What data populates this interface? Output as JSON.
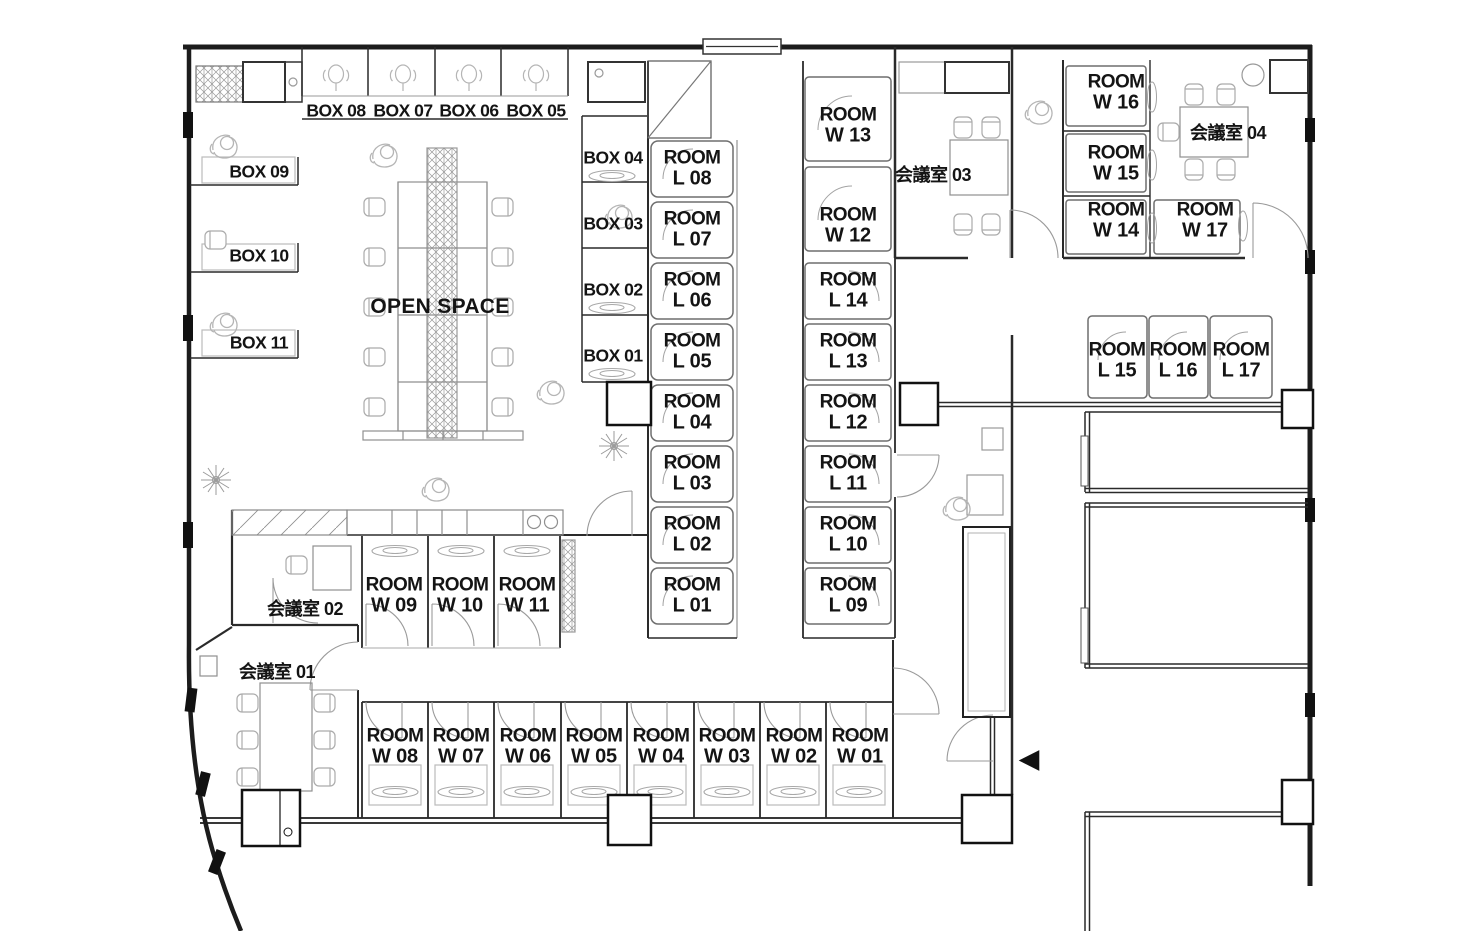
{
  "plan": {
    "open_space": "OPEN SPACE",
    "room_word": "ROOM",
    "entrance_arrow": "◀",
    "boxes": {
      "b01": "BOX 01",
      "b02": "BOX 02",
      "b03": "BOX 03",
      "b04": "BOX 04",
      "b05": "BOX 05",
      "b06": "BOX 06",
      "b07": "BOX 07",
      "b08": "BOX 08",
      "b09": "BOX 09",
      "b10": "BOX 10",
      "b11": "BOX 11"
    },
    "l_rooms": {
      "l01": "L 01",
      "l02": "L 02",
      "l03": "L 03",
      "l04": "L 04",
      "l05": "L 05",
      "l06": "L 06",
      "l07": "L 07",
      "l08": "L 08",
      "l09": "L 09",
      "l10": "L 10",
      "l11": "L 11",
      "l12": "L 12",
      "l13": "L 13",
      "l14": "L 14",
      "l15": "L 15",
      "l16": "L 16",
      "l17": "L 17"
    },
    "w_rooms": {
      "w01": "W 01",
      "w02": "W 02",
      "w03": "W 03",
      "w04": "W 04",
      "w05": "W 05",
      "w06": "W 06",
      "w07": "W 07",
      "w08": "W 08",
      "w09": "W 09",
      "w10": "W 10",
      "w11": "W 11",
      "w12": "W 12",
      "w13": "W 13",
      "w14": "W 14",
      "w15": "W 15",
      "w16": "W 16",
      "w17": "W 17"
    },
    "meeting_rooms": {
      "m01": "会議室 01",
      "m02": "会議室 02",
      "m03": "会議室 03",
      "m04": "会議室 04"
    }
  }
}
